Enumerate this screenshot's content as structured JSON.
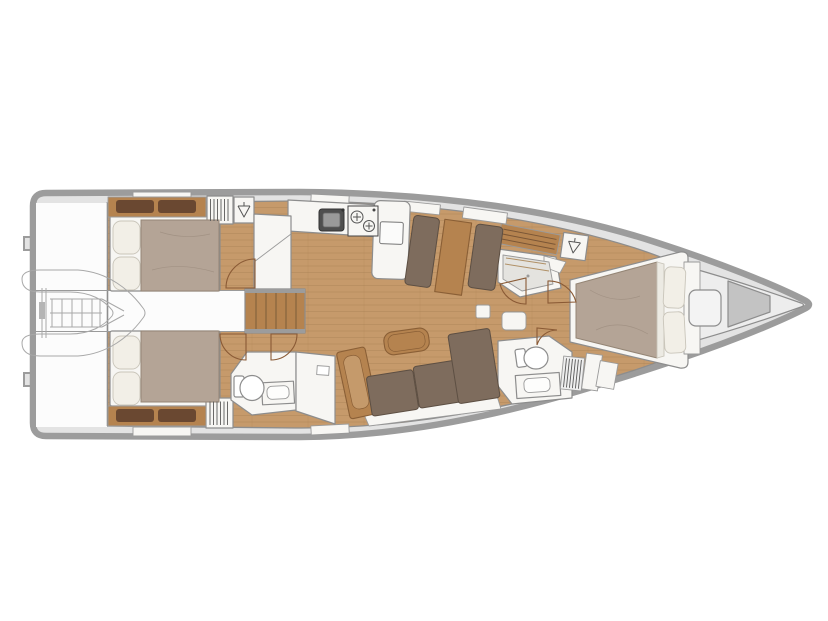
{
  "meta": {
    "type": "yacht-interior-floor-plan",
    "view": "top-down deck plan, bow to the right, stern to the left",
    "visible_text": "none"
  },
  "palette": {
    "page_bg": "#ffffff",
    "hull_band": "#9c9c9c",
    "side_deck": "#e3e3e3",
    "floor_wood": "#c69a6b",
    "plank_line": "#a87e52",
    "wood_mid": "#b5834f",
    "wood_dark": "#8a5f36",
    "headboard": "#6a4831",
    "furniture_white": "#f7f6f3",
    "white_area": "#fcfcfc",
    "outline": "#8d8d8d",
    "cushion": "#7e6c5d",
    "cushion_edge": "#5d4f43",
    "duvet": "#b4a496",
    "duvet_edge": "#948575",
    "pillow": "#f2efe7",
    "door_arc": "#8a5a35",
    "fixture_dark": "#4f4f4f",
    "fixture_inner": "#9a9a9a",
    "bow_locker": "#ededed",
    "bow_mid": "#c3c3c3",
    "shower_pan": "#e4e3df",
    "tender_line": "#a8a8a8"
  },
  "legend": {
    "hull": "sailboat hull outline with side decks",
    "tender_garage": "stern platform with stowed inflatable dinghy (ghost outline)",
    "aft_cabin_starboard": "aft double-berth cabin, starboard",
    "aft_cabin_port": "aft double-berth cabin, port",
    "companionway": "central companionway stairs between aft cabins",
    "galley": "starboard galley: sink, two-burner stove, peninsula counter, fridge column",
    "dinette": "starboard facing settees with table",
    "salon": "port L-sofa with chaise, wood armrest and coffee table",
    "day_heads": "aft-port toilet room with washbasin and locker",
    "shower_room": "starboard separate shower stall with teak bench",
    "hanging_lockers": "wardrobe squares with hanger symbol",
    "owners_cabin": "forward owner's cabin with island double berth",
    "owners_heads": "forward-port toilet room with washbasin and louver locker",
    "bow_locker": "forepeak sail/anchor locker with deck hatch"
  }
}
